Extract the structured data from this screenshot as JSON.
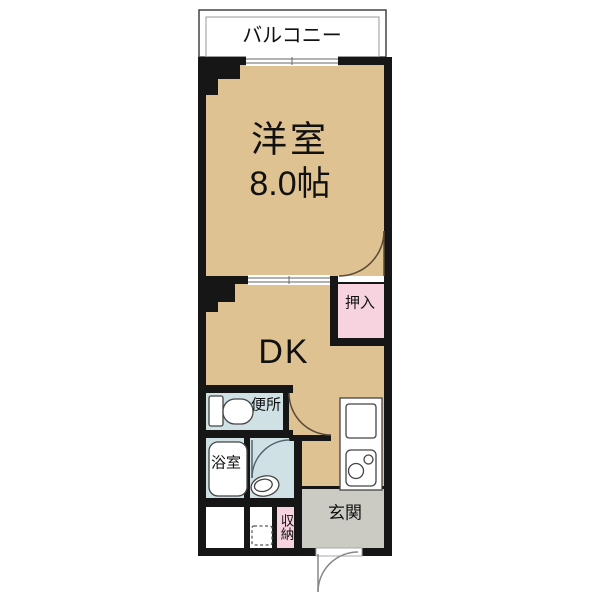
{
  "plan": {
    "balcony": {
      "label": "バルコニー"
    },
    "western_room": {
      "label": "洋室",
      "size": "8.0帖"
    },
    "closet_oshiire": {
      "label": "押入"
    },
    "dining_kitchen": {
      "label": "DK"
    },
    "toilet": {
      "label": "便所"
    },
    "bathroom": {
      "label": "浴室"
    },
    "storage": {
      "label": "収納"
    },
    "entrance": {
      "label": "玄関"
    }
  },
  "colors": {
    "floor": "#DFC291",
    "closet": "#F6D3DF",
    "wet_area": "#CFE1E4",
    "entrance": "#CBCBC3",
    "wall": "#161616"
  }
}
